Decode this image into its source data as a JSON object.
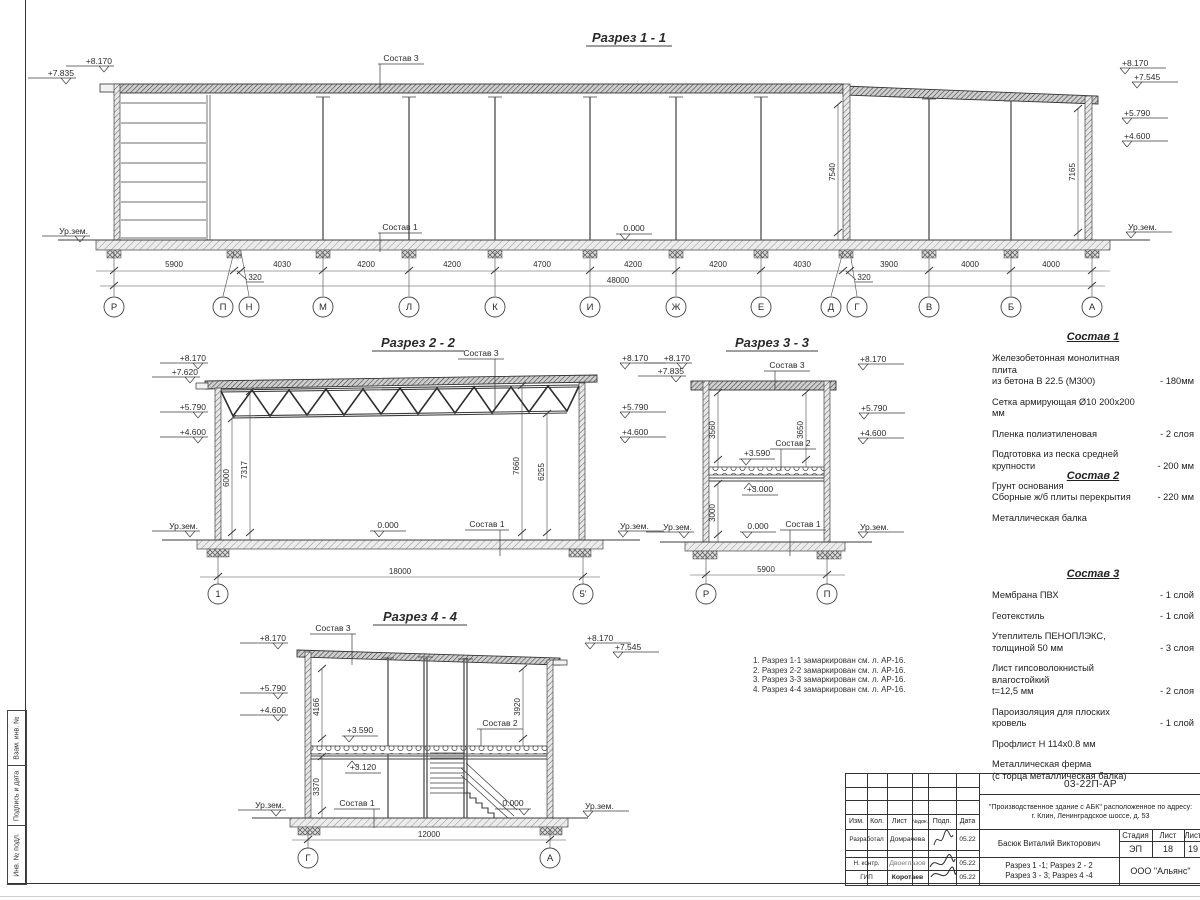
{
  "s1": {
    "title": "Разрез 1 - 1",
    "lvl_l1": "+8.170",
    "lvl_l2": "+7.835",
    "gnd_l": "Ур.зем.",
    "lvl_r1": "+8.170",
    "lvl_r2": "+7.545",
    "lvl_r3": "+5.790",
    "lvl_r4": "+4.600",
    "gnd_r": "Ур.зем.",
    "sostav3": "Состав 3",
    "sostav1": "Состав 1",
    "zero": "0.000",
    "vdim1": "7540",
    "vdim2": "7165",
    "d1": "5900",
    "d2": "4030",
    "d3": "4200",
    "d4": "4200",
    "d5": "4700",
    "d6": "4200",
    "d7": "4200",
    "d8": "4030",
    "d9": "3900",
    "d10": "4000",
    "d11": "4000",
    "off1": "320",
    "off2": "320",
    "total": "48000",
    "g1": "Р",
    "g2": "П",
    "g3": "Н",
    "g4": "М",
    "g5": "Л",
    "g6": "К",
    "g7": "И",
    "g8": "Ж",
    "g9": "Е",
    "g10": "Д",
    "g11": "Г",
    "g12": "В",
    "g13": "Б",
    "g14": "А"
  },
  "s2": {
    "title": "Разрез 2 - 2",
    "lvl_l1": "+8.170",
    "lvl_l2": "+7.620",
    "lvl_l3": "+5.790",
    "lvl_l4": "+4.600",
    "gnd_l": "Ур.зем.",
    "lvl_r1": "+8.170",
    "lvl_r2": "+5.790",
    "lvl_r3": "+4.600",
    "gnd_r": "Ур.зем.",
    "sostav3": "Состав 3",
    "sostav1": "Состав 1",
    "zero": "0.000",
    "vd1": "6000",
    "vd2": "7317",
    "vd3": "7660",
    "vd4": "6255",
    "total": "18000",
    "g1": "1",
    "g2": "5'"
  },
  "s3": {
    "title": "Разрез 3 - 3",
    "lvl_l1": "+8.170",
    "lvl_l2": "+7.835",
    "gnd_l": "Ур.зем.",
    "lvl_r1": "+8.170",
    "lvl_r2": "+5.790",
    "lvl_r3": "+4.600",
    "gnd_r": "Ур.зем.",
    "sostav3": "Состав 3",
    "sostav2": "Состав 2",
    "sostav1": "Состав 1",
    "m1": "+3.590",
    "m2": "+3.000",
    "zero": "0.000",
    "vd1": "3560",
    "vd2": "3650",
    "vd3": "3000",
    "total": "5900",
    "g1": "Р",
    "g2": "П"
  },
  "s4": {
    "title": "Разрез 4 - 4",
    "lvl_l1": "+8.170",
    "lvl_l2": "+5.790",
    "lvl_l3": "+4.600",
    "gnd_l": "Ур.зем.",
    "lvl_r1": "+8.170",
    "lvl_r2": "+7.545",
    "gnd_r": "Ур.зем.",
    "sostav3": "Состав 3",
    "sostav2": "Состав 2",
    "sostav1": "Состав 1",
    "m1": "+3.590",
    "m2": "+3.120",
    "zero": "0.000",
    "vd1": "4166",
    "vd2": "3920",
    "vd3": "3370",
    "total": "12000",
    "g1": "Г",
    "g2": "А"
  },
  "notes": {
    "n1": "1. Разрез 1-1 замаркирован см. л. АР-16.",
    "n2": "2. Разрез 2-2 замаркирован см. л. АР-16.",
    "n3": "3. Разрез 3-3 замаркирован см. л. АР-16.",
    "n4": "4. Разрез 4-4 замаркирован см. л. АР-16."
  },
  "sostav1": {
    "title": "Состав 1",
    "items": [
      {
        "l1": "Железобетонная  монолитная плита",
        "l2": "из бетона В 22.5 (М300)",
        "v": "- 180мм"
      },
      {
        "l1": "Сетка армирующая Ø10 200х200 мм"
      },
      {
        "l1": "Пленка полиэтиленовая",
        "v": "-  2 слоя"
      },
      {
        "l1": "Подготовка из песка средней",
        "l2": "крупности",
        "v": "- 200 мм"
      },
      {
        "l1": "Грунт основания"
      }
    ]
  },
  "sostav2": {
    "title": "Состав 2",
    "items": [
      {
        "l1": "Сборные ж/б плиты перекрытия",
        "v": "- 220 мм"
      },
      {
        "l1": "Металлическая балка"
      }
    ]
  },
  "sostav3": {
    "title": "Состав 3",
    "items": [
      {
        "l1": "Мембрана ПВХ",
        "v": "- 1 слой"
      },
      {
        "l1": "Геотекстиль",
        "v": "- 1 слой"
      },
      {
        "l1": "Утеплитель ПЕНОПЛЭКС,",
        "l2": "толщиной 50 мм",
        "v": "- 3 слоя"
      },
      {
        "l1": "Лист гипсоволокнистый влагостойкий",
        "l2": "t=12,5 мм",
        "v": "- 2 слоя"
      },
      {
        "l1": "Пароизоляция для плоских кровель",
        "v": "- 1 слой"
      },
      {
        "l1": "Профлист Н 114х0.8 мм"
      },
      {
        "l1": "Металлическая ферма",
        "l2": "(с торца металлическая балка)"
      }
    ]
  },
  "titleblock": {
    "doc_number": "03-22П-АР",
    "object_line1": "\"Производственное здание с АБК\" расположенное по адресу:",
    "object_line2": "г. Клин, Ленинградское шоссе, д. 53",
    "cols": {
      "izm": "Изм.",
      "kol": "Кол.",
      "list": "Лист",
      "ndok": "№док.",
      "podp": "Подп.",
      "data": "Дата"
    },
    "rows": [
      {
        "role": "Разработал",
        "name": "Домрачева",
        "date": "05.22"
      },
      {
        "role": "Н. контр.",
        "name": "Двоеглазов",
        "date": "05.22"
      },
      {
        "role": "ГИП",
        "name": "Коротаев",
        "date": "05.22"
      }
    ],
    "author": "Басюк Виталий Викторович",
    "sheet_title_line1": "Разрез 1 -1;  Разрез 2 - 2",
    "sheet_title_line2": "Разрез 3 - 3;  Разрез 4 -4",
    "stage_label": "Стадия",
    "sheet_label": "Лист",
    "sheets_label": "Лист",
    "stage": "ЭП",
    "sheet": "18",
    "sheets": "19",
    "company": "ООО \"Альянс\""
  },
  "side_strip": {
    "c1": "Взам. инв. №",
    "c2": "Подпись и дата",
    "c3": "Инв. № подл."
  }
}
